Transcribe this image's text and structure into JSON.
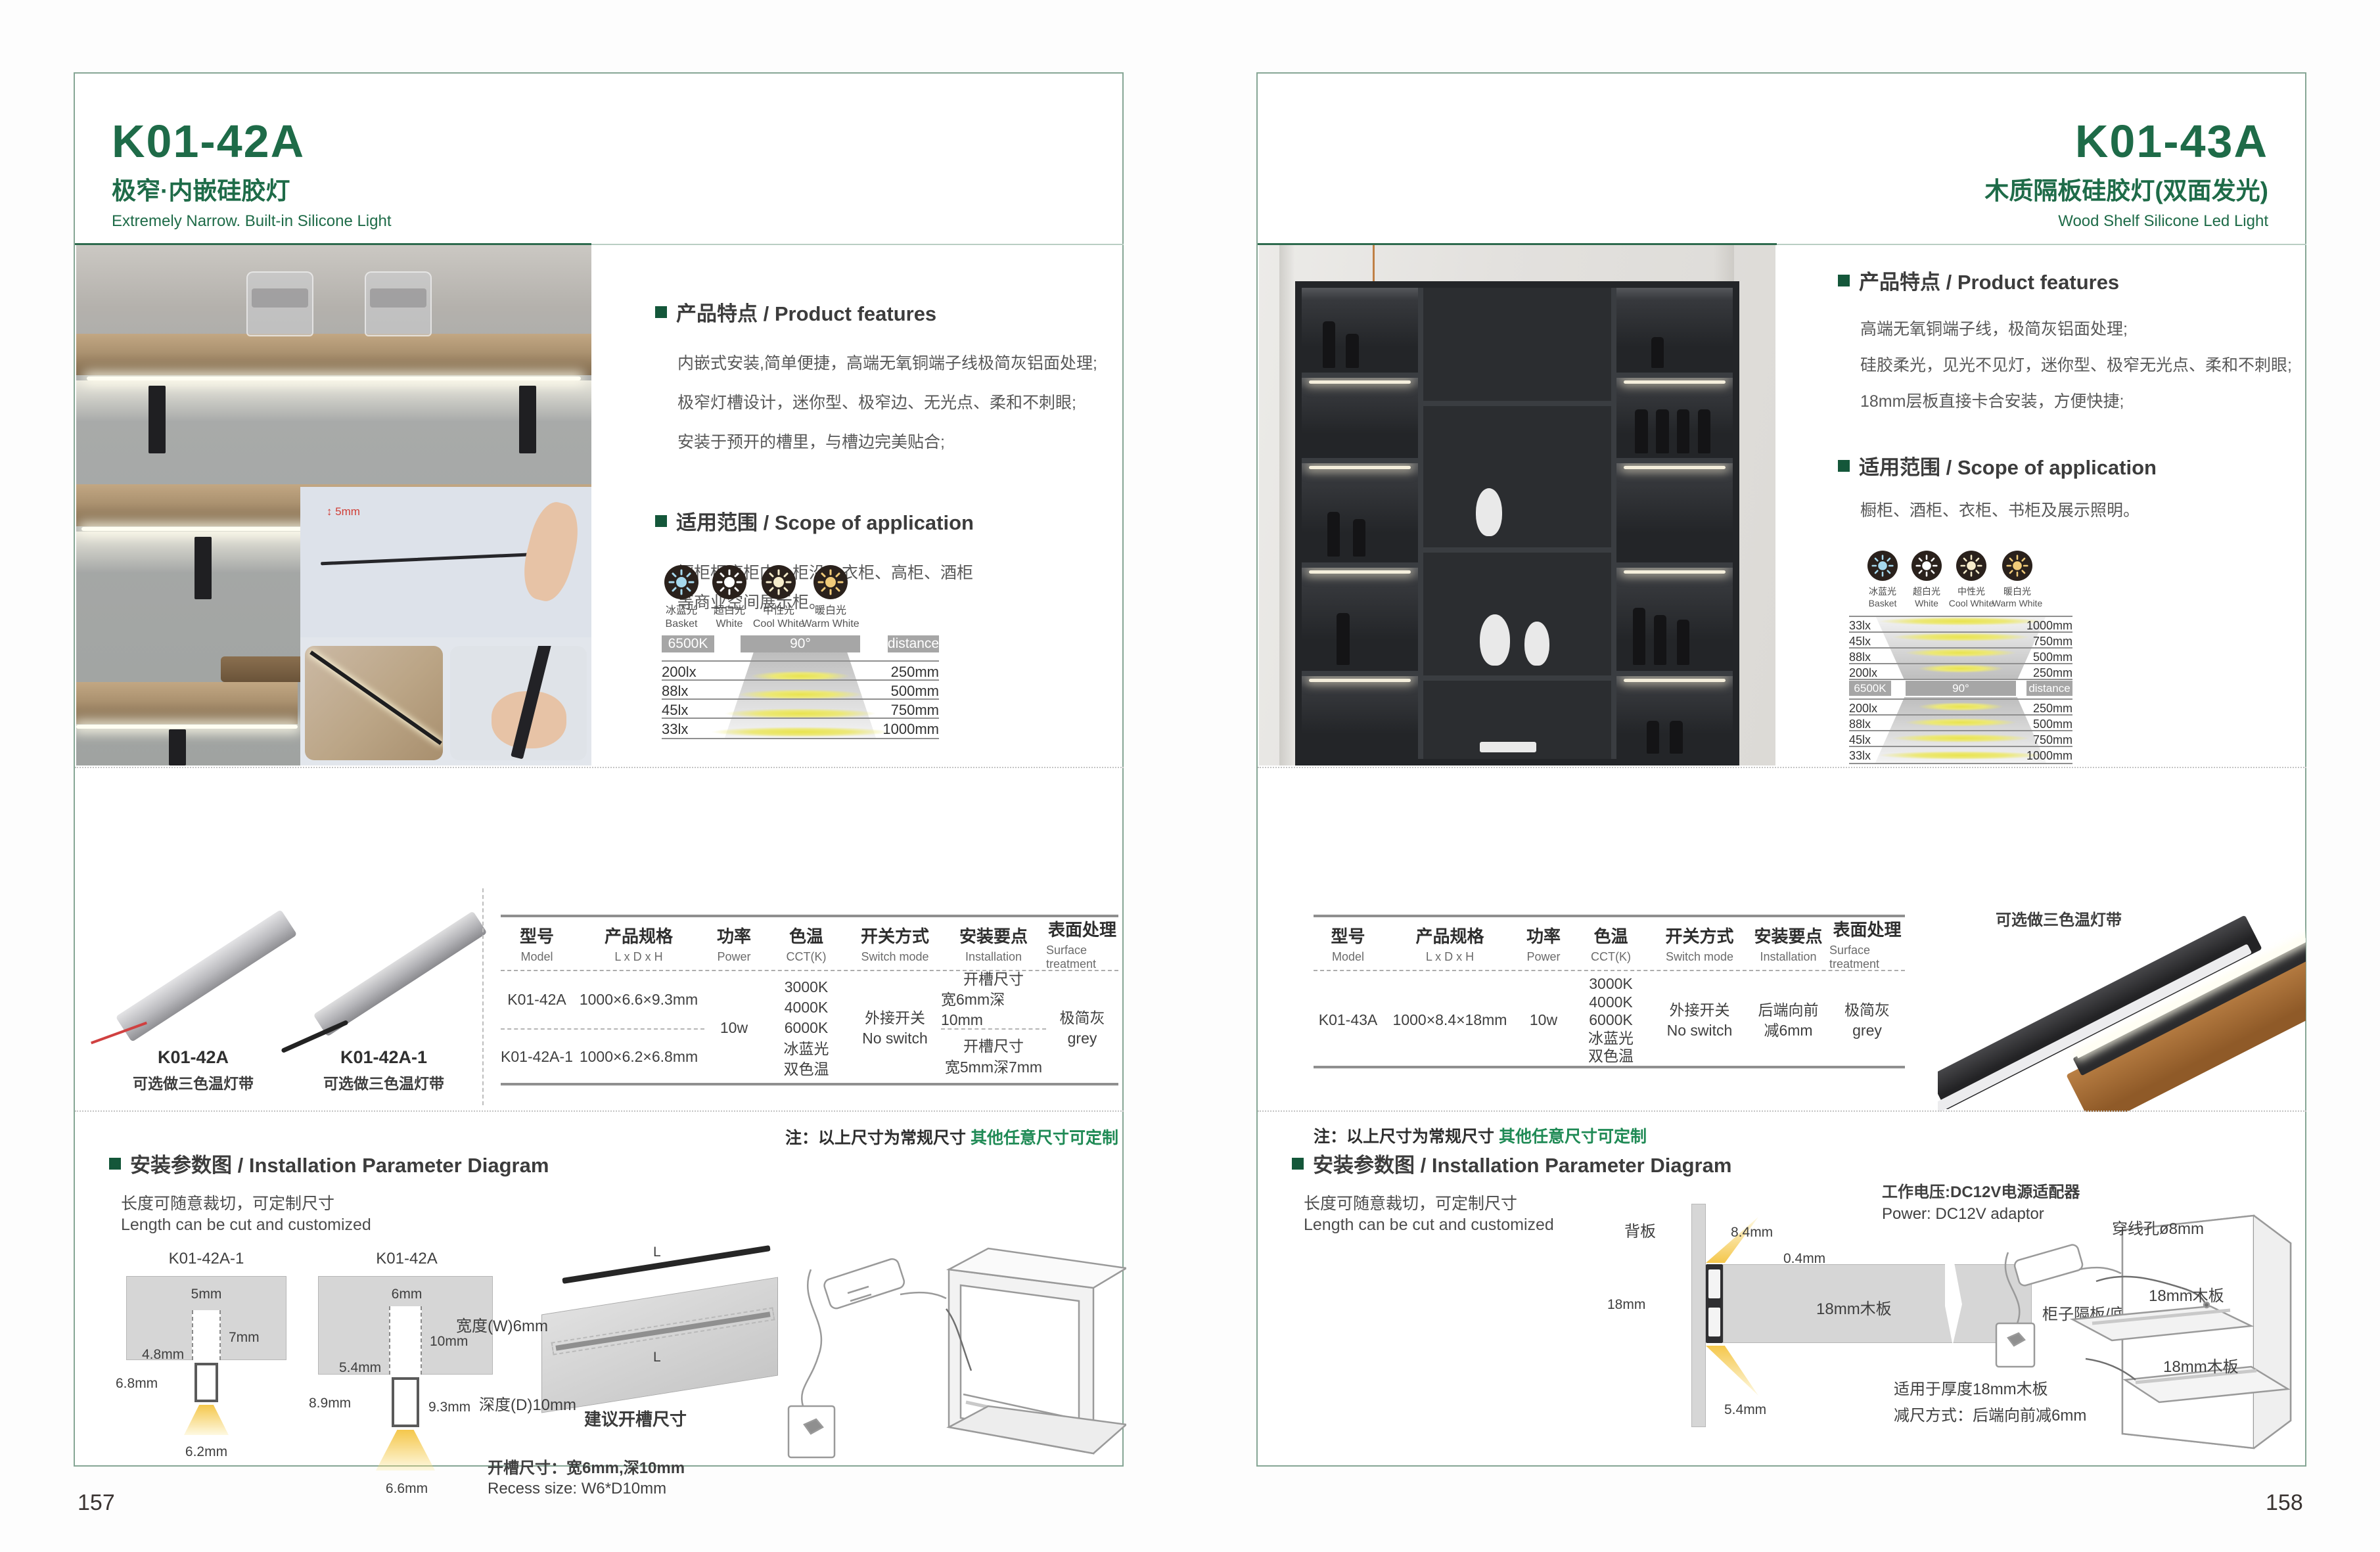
{
  "shared": {
    "features_heading": "产品特点 / Product features",
    "scope_heading": "适用范围 / Scope of application",
    "install_heading": "安装参数图 / Installation Parameter Diagram",
    "cut_cn": "长度可随意裁切，可定制尺寸",
    "cut_en": "Length can be cut and customized",
    "note_prefix": "注：以上尺寸为常规尺寸 ",
    "note_green": "其他任意尺寸可定制",
    "light_icons": [
      {
        "cn": "冰蓝光",
        "en": "Basket",
        "color": "#a6d9ee"
      },
      {
        "cn": "超白光",
        "en": "White",
        "color": "#ffffff"
      },
      {
        "cn": "中性光",
        "en": "Cool White",
        "color": "#f6eccb"
      },
      {
        "cn": "暖白光",
        "en": "Warm White",
        "color": "#f1cb79"
      }
    ],
    "chart_headers": {
      "cct": "6500K",
      "angle": "90°",
      "dist": "distance"
    },
    "table_headers": [
      {
        "cn": "型号",
        "en": "Model"
      },
      {
        "cn": "产品规格",
        "en": "L x D x H"
      },
      {
        "cn": "功率",
        "en": "Power"
      },
      {
        "cn": "色温",
        "en": "CCT(K)"
      },
      {
        "cn": "开关方式",
        "en": "Switch mode"
      },
      {
        "cn": "安装要点",
        "en": "Installation"
      },
      {
        "cn": "表面处理",
        "en": "Surface treatment"
      }
    ],
    "cct_options": [
      "3000K",
      "4000K",
      "6000K",
      "冰蓝光",
      "双色温"
    ],
    "switch_cn": "外接开关",
    "switch_en": "No switch",
    "surface_cn": "极简灰",
    "surface_en": "grey",
    "power": "10w",
    "tri_color_caption": "可选做三色温灯带"
  },
  "left": {
    "page_number": "157",
    "model": "K01-42A",
    "title_cn": "极窄·内嵌硅胶灯",
    "title_en": "Extremely Narrow. Built-in Silicone Light",
    "features": [
      "内嵌式安装,简单便捷，高端无氧铜端子线极简灰铝面处理;",
      "极窄灯槽设计，迷你型、极窄边、无光点、柔和不刺眼;",
      "安装于预开的槽里，与槽边完美贴合;"
    ],
    "scope": [
      "橱柜柜底柜内、柜沿、衣柜、高柜、酒柜",
      "等商业空间展示柜。"
    ],
    "photo_dim_label": "5mm",
    "chart_rows": [
      {
        "lux": "200lx",
        "dist": "250mm"
      },
      {
        "lux": "88lx",
        "dist": "500mm"
      },
      {
        "lux": "45lx",
        "dist": "750mm"
      },
      {
        "lux": "33lx",
        "dist": "1000mm"
      }
    ],
    "products": [
      {
        "model": "K01-42A"
      },
      {
        "model": "K01-42A-1"
      }
    ],
    "table_rows": [
      {
        "model": "K01-42A",
        "spec": "1000×6.6×9.3mm",
        "install_cn": "开槽尺寸",
        "install_detail": "宽6mm深10mm"
      },
      {
        "model": "K01-42A-1",
        "spec": "1000×6.2×6.8mm",
        "install_cn": "开槽尺寸",
        "install_detail": "宽5mm深7mm"
      }
    ],
    "install": {
      "diagram_a": {
        "title": "K01-42A-1",
        "top": "5mm",
        "depth": "7mm",
        "inner": "4.8mm",
        "height": "6.8mm",
        "width": "6.2mm"
      },
      "diagram_b": {
        "title": "K01-42A",
        "top": "6mm",
        "depth": "10mm",
        "inner": "5.4mm",
        "height": "8.9mm",
        "side": "9.3mm",
        "width": "6.6mm"
      },
      "board": {
        "w": "宽度(W)6mm",
        "d": "深度(D)10mm",
        "suggest": "建议开槽尺寸",
        "len1": "L",
        "len2": "L"
      },
      "recess_cn": "开槽尺寸：宽6mm,深10mm",
      "recess_en": "Recess size: W6*D10mm"
    }
  },
  "right": {
    "page_number": "158",
    "model": "K01-43A",
    "title_cn": "木质隔板硅胶灯(双面发光)",
    "title_en": "Wood Shelf Silicone Led Light",
    "features": [
      "高端无氧铜端子线，极简灰铝面处理;",
      "硅胶柔光，见光不见灯，迷你型、极窄无光点、柔和不刺眼;",
      "18mm层板直接卡合安装，方便快捷;"
    ],
    "scope": [
      "橱柜、酒柜、衣柜、书柜及展示照明。"
    ],
    "chart_rows_top": [
      {
        "lux": "33lx",
        "dist": "1000mm"
      },
      {
        "lux": "45lx",
        "dist": "750mm"
      },
      {
        "lux": "88lx",
        "dist": "500mm"
      },
      {
        "lux": "200lx",
        "dist": "250mm"
      }
    ],
    "chart_rows_bottom": [
      {
        "lux": "200lx",
        "dist": "250mm"
      },
      {
        "lux": "88lx",
        "dist": "500mm"
      },
      {
        "lux": "45lx",
        "dist": "750mm"
      },
      {
        "lux": "33lx",
        "dist": "1000mm"
      }
    ],
    "table_row": {
      "model": "K01-43A",
      "spec": "1000×8.4×18mm",
      "install_cn": "后端向前",
      "install_detail": "减6mm"
    },
    "install": {
      "power_cn": "工作电压:DC12V电源适配器",
      "power_en": "Power: DC12V adaptor",
      "back_panel": "背板",
      "dim_84": "8.4mm",
      "dim_04": "0.4mm",
      "dim_18": "18mm",
      "board_label": "18mm木板",
      "shelf_label": "柜子隔板/底板",
      "dim_54": "5.4mm",
      "fit_note": "适用于厚度18mm木板",
      "reduce_note": "减尺方式：后端向前减6mm",
      "hole_label": "穿线孔ø8mm",
      "cab_board1": "18mm木板",
      "cab_board2": "18mm木板"
    }
  }
}
